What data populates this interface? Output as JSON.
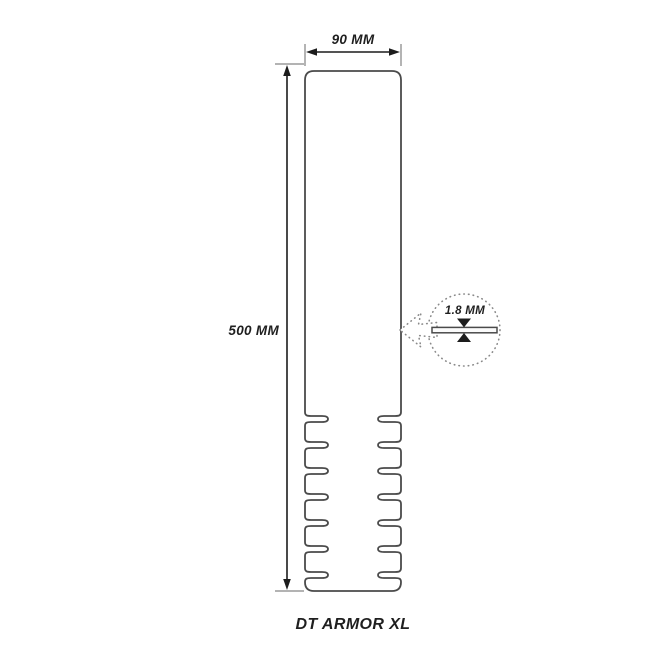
{
  "diagram": {
    "product_label": "DT ARMOR XL",
    "width_dimension": "90 MM",
    "height_dimension": "500 MM",
    "thickness_dimension": "1.8 MM"
  },
  "colors": {
    "background": "#ffffff",
    "outline": "#4a4a4a",
    "dimension_line": "#1c1c1c",
    "extension_tick": "#9a9a9a",
    "dotted_detail": "#8a8a8a",
    "text": "#1f1f1f"
  }
}
